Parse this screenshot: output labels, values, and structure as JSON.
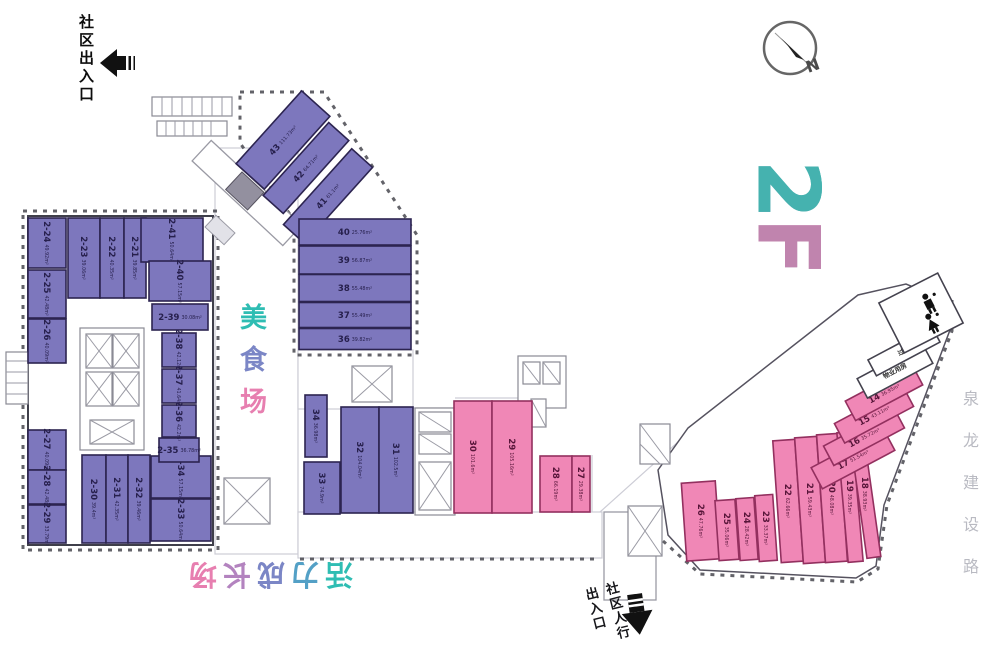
{
  "floor_logo": {
    "text": "2F",
    "char_colors": [
      "#45b2af",
      "#c084ae"
    ]
  },
  "labels": {
    "entrance_top_left": "社区出入口",
    "food_court": {
      "text": "美食场",
      "char_colors": [
        "#2fbdb3",
        "#7b86c6",
        "#e77fb0"
      ]
    },
    "growth_area": {
      "text": "活力成长场",
      "char_colors": [
        "#2fbdb3",
        "#53a0c6",
        "#7b86c6",
        "#b383bf",
        "#e77fb0"
      ]
    },
    "pedestrian_entrance_line1": "社区人行",
    "pedestrian_entrance_line2": "出入口",
    "road": "泉龙建设路",
    "compass_north": "N"
  },
  "colors": {
    "unit_purple": "#7d77bd",
    "unit_purple_stroke": "#2c2450",
    "unit_pink": "#f087b6",
    "unit_pink_stroke": "#93305f",
    "teal_accent": "#2fbdb3",
    "pink_accent": "#e77fb0"
  },
  "units": [
    {
      "num": "43",
      "area": "111.73m²",
      "fill": "purple",
      "cx": 283,
      "cy": 140,
      "w": 98,
      "h": 38,
      "rot": -48,
      "lrot": -48
    },
    {
      "num": "42",
      "area": "64.71m²",
      "fill": "purple",
      "cx": 306,
      "cy": 168,
      "w": 98,
      "h": 27,
      "rot": -48,
      "lrot": -48
    },
    {
      "num": "41",
      "area": "61.1m²",
      "fill": "purple",
      "cx": 328,
      "cy": 196,
      "w": 102,
      "h": 28,
      "rot": -48,
      "lrot": -48
    },
    {
      "num": "40",
      "area": "25.76m²",
      "fill": "purple",
      "cx": 355,
      "cy": 232,
      "w": 112,
      "h": 26,
      "rot": 0,
      "lrot": 0
    },
    {
      "num": "39",
      "area": "56.87m²",
      "fill": "purple",
      "cx": 355,
      "cy": 260,
      "w": 112,
      "h": 28,
      "rot": 0,
      "lrot": 0
    },
    {
      "num": "38",
      "area": "55.48m²",
      "fill": "purple",
      "cx": 355,
      "cy": 288,
      "w": 112,
      "h": 27,
      "rot": 0,
      "lrot": 0
    },
    {
      "num": "37",
      "area": "55.49m²",
      "fill": "purple",
      "cx": 355,
      "cy": 315,
      "w": 112,
      "h": 25,
      "rot": 0,
      "lrot": 0
    },
    {
      "num": "36",
      "area": "39.82m²",
      "fill": "purple",
      "cx": 355,
      "cy": 339,
      "w": 112,
      "h": 21,
      "rot": 0,
      "lrot": 0
    },
    {
      "num": "2-24",
      "area": "49.92m²",
      "fill": "purple",
      "cx": 47,
      "cy": 243,
      "w": 38,
      "h": 50,
      "rot": 0,
      "lrot": 90
    },
    {
      "num": "2-23",
      "area": "39.06m²",
      "fill": "purple",
      "cx": 84,
      "cy": 258,
      "w": 32,
      "h": 80,
      "rot": 0,
      "lrot": 90
    },
    {
      "num": "2-22",
      "area": "40.35m²",
      "fill": "purple",
      "cx": 112,
      "cy": 258,
      "w": 24,
      "h": 80,
      "rot": 0,
      "lrot": 90
    },
    {
      "num": "2-21",
      "area": "39.85m²",
      "fill": "purple",
      "cx": 135,
      "cy": 258,
      "w": 22,
      "h": 80,
      "rot": 0,
      "lrot": 90
    },
    {
      "num": "2-41",
      "area": "50.64m²",
      "fill": "purple",
      "cx": 172,
      "cy": 240,
      "w": 62,
      "h": 44,
      "rot": 0,
      "lrot": 90
    },
    {
      "num": "2-40",
      "area": "57.15m²",
      "fill": "purple",
      "cx": 180,
      "cy": 281,
      "w": 62,
      "h": 40,
      "rot": 0,
      "lrot": 90
    },
    {
      "num": "2-25",
      "area": "42.48m²",
      "fill": "purple",
      "cx": 47,
      "cy": 294,
      "w": 38,
      "h": 48,
      "rot": 0,
      "lrot": 90
    },
    {
      "num": "2-26",
      "area": "40.09m²",
      "fill": "purple",
      "cx": 47,
      "cy": 341,
      "w": 38,
      "h": 44,
      "rot": 0,
      "lrot": 90
    },
    {
      "num": "2-27",
      "area": "40.09m²",
      "fill": "purple",
      "cx": 47,
      "cy": 450,
      "w": 38,
      "h": 40,
      "rot": 0,
      "lrot": 90
    },
    {
      "num": "2-28",
      "area": "42.48m²",
      "fill": "purple",
      "cx": 47,
      "cy": 487,
      "w": 38,
      "h": 34,
      "rot": 0,
      "lrot": 90
    },
    {
      "num": "2-29",
      "area": "33.79m²",
      "fill": "purple",
      "cx": 47,
      "cy": 524,
      "w": 38,
      "h": 38,
      "rot": 0,
      "lrot": 90
    },
    {
      "num": "2-30",
      "area": "39.4m²",
      "fill": "purple",
      "cx": 94,
      "cy": 499,
      "w": 24,
      "h": 88,
      "rot": 0,
      "lrot": 90
    },
    {
      "num": "2-31",
      "area": "42.35m²",
      "fill": "purple",
      "cx": 117,
      "cy": 499,
      "w": 22,
      "h": 88,
      "rot": 0,
      "lrot": 90
    },
    {
      "num": "2-32",
      "area": "39.46m²",
      "fill": "purple",
      "cx": 139,
      "cy": 499,
      "w": 22,
      "h": 88,
      "rot": 0,
      "lrot": 90
    },
    {
      "num": "2-33",
      "area": "50.64m²",
      "fill": "purple",
      "cx": 181,
      "cy": 520,
      "w": 60,
      "h": 42,
      "rot": 0,
      "lrot": 90
    },
    {
      "num": "2-34",
      "area": "57.15m²",
      "fill": "purple",
      "cx": 181,
      "cy": 477,
      "w": 60,
      "h": 42,
      "rot": 0,
      "lrot": 90
    },
    {
      "num": "2-35",
      "area": "36.78m²",
      "fill": "purple",
      "cx": 179,
      "cy": 450,
      "w": 40,
      "h": 24,
      "rot": 0,
      "lrot": 0
    },
    {
      "num": "2-36",
      "area": "42.2m²",
      "fill": "purple",
      "cx": 179,
      "cy": 421,
      "w": 34,
      "h": 32,
      "rot": 0,
      "lrot": 90
    },
    {
      "num": "2-37",
      "area": "41.64m²",
      "fill": "purple",
      "cx": 179,
      "cy": 386,
      "w": 34,
      "h": 34,
      "rot": 0,
      "lrot": 90
    },
    {
      "num": "2-38",
      "area": "42.12m²",
      "fill": "purple",
      "cx": 179,
      "cy": 350,
      "w": 34,
      "h": 34,
      "rot": 0,
      "lrot": 90
    },
    {
      "num": "2-39",
      "area": "30.08m²",
      "fill": "purple",
      "cx": 180,
      "cy": 317,
      "w": 56,
      "h": 26,
      "rot": 0,
      "lrot": 0
    },
    {
      "num": "34",
      "area": "36.98m²",
      "fill": "purple",
      "cx": 316,
      "cy": 426,
      "w": 22,
      "h": 62,
      "rot": 0,
      "lrot": 90
    },
    {
      "num": "33",
      "area": "74.9m²",
      "fill": "purple",
      "cx": 322,
      "cy": 488,
      "w": 36,
      "h": 52,
      "rot": 0,
      "lrot": 90
    },
    {
      "num": "32",
      "area": "104.04m²",
      "fill": "purple",
      "cx": 360,
      "cy": 460,
      "w": 38,
      "h": 106,
      "rot": 0,
      "lrot": 90
    },
    {
      "num": "31",
      "area": "102.5m²",
      "fill": "purple",
      "cx": 396,
      "cy": 460,
      "w": 34,
      "h": 106,
      "rot": 0,
      "lrot": 90
    },
    {
      "num": "30",
      "area": "101.6m²",
      "fill": "pink",
      "cx": 473,
      "cy": 457,
      "w": 38,
      "h": 112,
      "rot": 0,
      "lrot": 90
    },
    {
      "num": "29",
      "area": "105.16m²",
      "fill": "pink",
      "cx": 512,
      "cy": 457,
      "w": 40,
      "h": 112,
      "rot": 0,
      "lrot": 90
    },
    {
      "num": "28",
      "area": "66.19m²",
      "fill": "pink",
      "cx": 556,
      "cy": 484,
      "w": 32,
      "h": 56,
      "rot": 0,
      "lrot": 90
    },
    {
      "num": "27",
      "area": "29.38m²",
      "fill": "pink",
      "cx": 581,
      "cy": 484,
      "w": 18,
      "h": 56,
      "rot": 0,
      "lrot": 90
    },
    {
      "num": "26",
      "area": "47.76m²",
      "fill": "pink",
      "cx": 701,
      "cy": 521,
      "w": 34,
      "h": 78,
      "rot": -4,
      "lrot": 90
    },
    {
      "num": "25",
      "area": "35.06m²",
      "fill": "pink",
      "cx": 727,
      "cy": 530,
      "w": 20,
      "h": 60,
      "rot": -4,
      "lrot": 90
    },
    {
      "num": "24",
      "area": "28.42m²",
      "fill": "pink",
      "cx": 747,
      "cy": 529,
      "w": 18,
      "h": 62,
      "rot": -4,
      "lrot": 90
    },
    {
      "num": "23",
      "area": "33.37m²",
      "fill": "pink",
      "cx": 766,
      "cy": 528,
      "w": 18,
      "h": 66,
      "rot": -4,
      "lrot": 90
    },
    {
      "num": "22",
      "area": "62.66m²",
      "fill": "pink",
      "cx": 788,
      "cy": 501,
      "w": 22,
      "h": 122,
      "rot": -4,
      "lrot": 90
    },
    {
      "num": "21",
      "area": "59.43m²",
      "fill": "pink",
      "cx": 810,
      "cy": 500,
      "w": 22,
      "h": 126,
      "rot": -4,
      "lrot": 90
    },
    {
      "num": "20",
      "area": "48.08m²",
      "fill": "pink",
      "cx": 832,
      "cy": 498,
      "w": 22,
      "h": 128,
      "rot": -4,
      "lrot": 90
    },
    {
      "num": "19",
      "area": "39.35m²",
      "fill": "pink",
      "cx": 850,
      "cy": 497,
      "w": 15,
      "h": 130,
      "rot": -5,
      "lrot": 90
    },
    {
      "num": "18",
      "area": "38.93m²",
      "fill": "pink",
      "cx": 865,
      "cy": 494,
      "w": 14,
      "h": 128,
      "rot": -8,
      "lrot": 90
    },
    {
      "num": "17",
      "area": "51.54m²",
      "fill": "pink",
      "cx": 853,
      "cy": 459,
      "w": 82,
      "h": 24,
      "rot": -28,
      "lrot": -28
    },
    {
      "num": "16",
      "area": "35.72m²",
      "fill": "pink",
      "cx": 864,
      "cy": 437,
      "w": 80,
      "h": 22,
      "rot": -28,
      "lrot": -28
    },
    {
      "num": "15",
      "area": "43.11m²",
      "fill": "pink",
      "cx": 874,
      "cy": 415,
      "w": 78,
      "h": 22,
      "rot": -28,
      "lrot": -28
    },
    {
      "num": "14",
      "area": "36.95m²",
      "fill": "pink",
      "cx": 884,
      "cy": 393,
      "w": 76,
      "h": 22,
      "rot": -28,
      "lrot": -28
    },
    {
      "name": "物业用房",
      "fill": "white",
      "cx": 895,
      "cy": 371,
      "w": 74,
      "h": 22,
      "rot": -28,
      "lrot": -28,
      "dn": "property-room"
    },
    {
      "name": "过道",
      "fill": "white",
      "cx": 904,
      "cy": 351,
      "w": 72,
      "h": 18,
      "rot": -28,
      "lrot": -28,
      "dn": "corridor-unit"
    },
    {
      "name": "",
      "fill": "white",
      "cx": 921,
      "cy": 313,
      "w": 66,
      "h": 56,
      "rot": -27,
      "lrot": -27,
      "dn": "restroom-room"
    }
  ]
}
